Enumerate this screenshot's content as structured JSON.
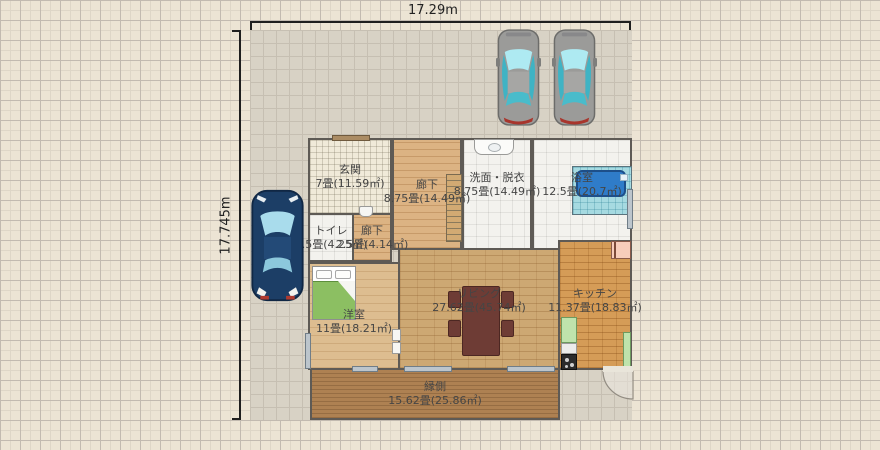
{
  "dims": {
    "width_label": "17.29m",
    "height_label": "17.745m"
  },
  "rooms": [
    {
      "name": "玄関",
      "size": "7畳(11.59㎡)"
    },
    {
      "name": "廊下",
      "size": "8.75畳(14.49㎡)"
    },
    {
      "name": "洗面・脱衣",
      "size": "8.75畳(14.49㎡)"
    },
    {
      "name": "浴室",
      "size": "12.5畳(20.7㎡)"
    },
    {
      "name": "トイレ",
      "size": "2.5畳(4.25㎡)"
    },
    {
      "name": "廊下",
      "size": "2.5畳(4.14㎡)"
    },
    {
      "name": "洋室",
      "size": "11畳(18.21㎡)"
    },
    {
      "name": "リビング",
      "size": "27.62畳(45.74㎡)"
    },
    {
      "name": "キッチン",
      "size": "11.37畳(18.83㎡)"
    },
    {
      "name": "縁側",
      "size": "15.62畳(25.86㎡)"
    }
  ],
  "objects": {
    "cars": [
      "gray-car",
      "gray-car",
      "blue-car"
    ],
    "fixtures": [
      "bed",
      "dining-table",
      "chairs",
      "bathtub",
      "washbasin",
      "toilet",
      "stairs",
      "kitchen-counter",
      "stove",
      "cabinets",
      "hinged-door"
    ]
  },
  "colors": {
    "background": "#ece4d4",
    "site_fill": "#d8d2c5",
    "wall": "#5e5a55",
    "tub_blue": "#2f7cc9",
    "bed_green": "#8cbf62",
    "cabinet_green": "#bfe3ac",
    "door_pink": "#f7cdbb",
    "car_gray": "#9b9b99",
    "car_blue": "#1c3e66",
    "dimension_line": "#1f1f1f"
  }
}
